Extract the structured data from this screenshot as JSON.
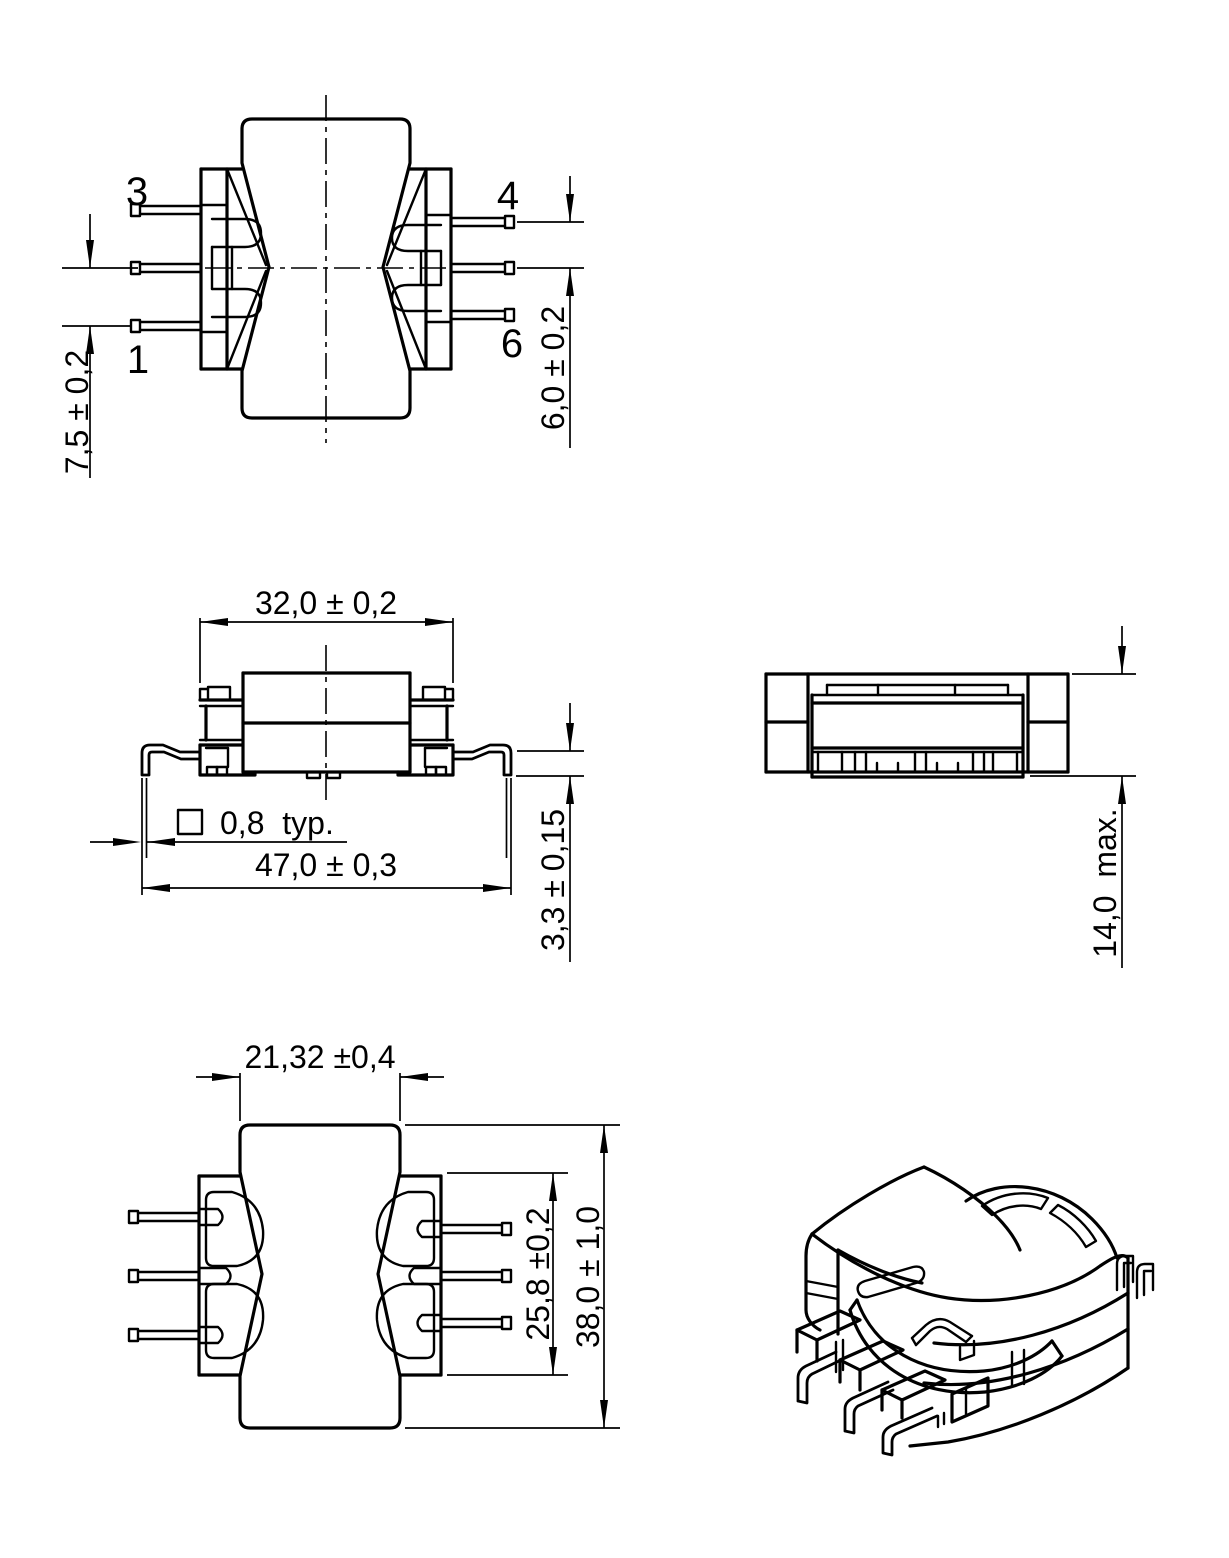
{
  "colors": {
    "background": "#ffffff",
    "line": "#000000"
  },
  "views": {
    "top_view": {
      "pin_top_left": "3",
      "pin_bottom_left": "1",
      "pin_top_right": "4",
      "pin_bottom_right": "6",
      "dim_pin_pitch_left": "7,5 ± 0,2",
      "dim_pin_pitch_right": "6,0 ± 0,2"
    },
    "front_view": {
      "dim_body_width": "32,0 ± 0,2",
      "dim_lead_span": "47,0 ± 0,3",
      "dim_lead_size": "0,8  typ.",
      "dim_standoff": "3,3 ± 0,15"
    },
    "side_view": {
      "dim_height": "14,0  max."
    },
    "bottom_view": {
      "dim_core_width": "21,32 ±0,4",
      "dim_flange_length": "25,8 ±0,2",
      "dim_core_length": "38,0 ± 1,0"
    }
  }
}
